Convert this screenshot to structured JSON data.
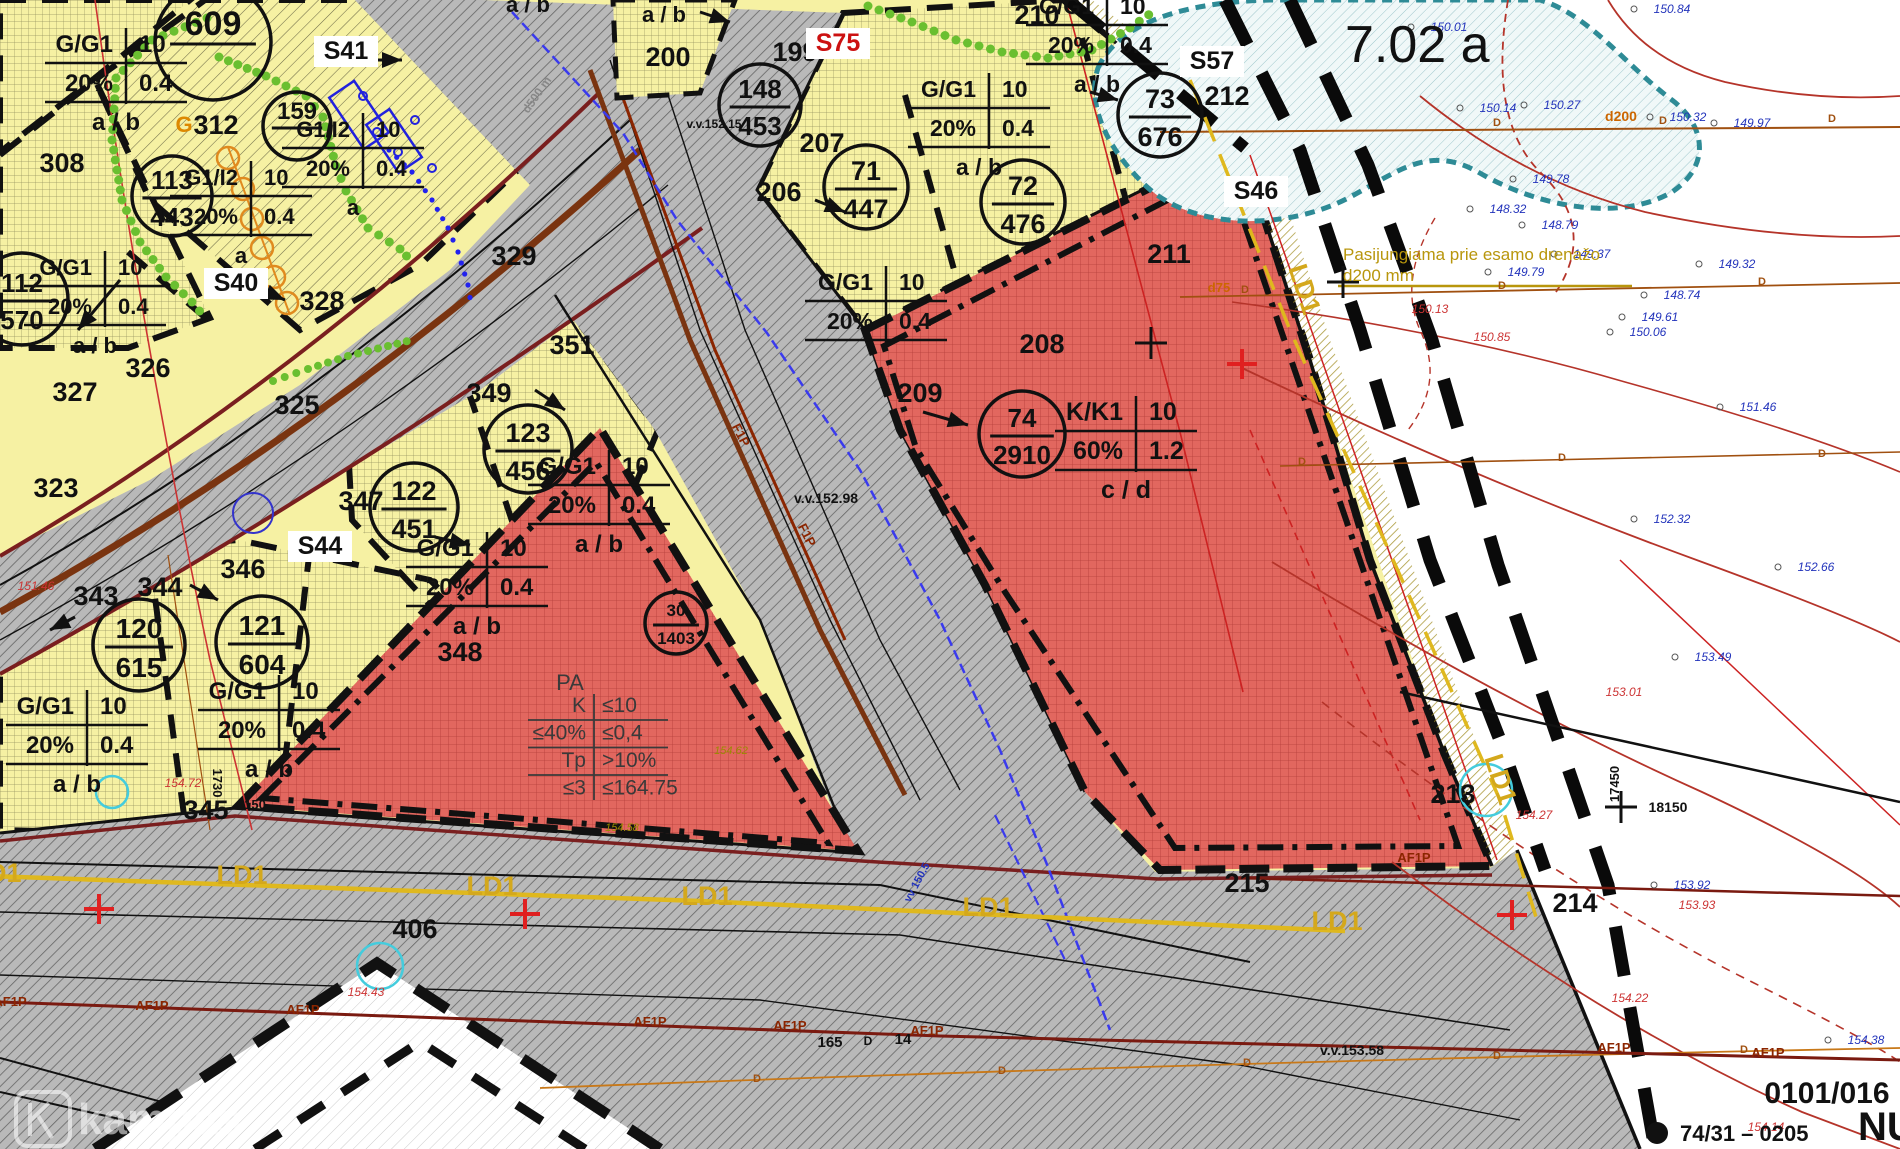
{
  "map": {
    "sheet_label": "7.02 a",
    "watermark": "kampas",
    "corner_code": "0101/016",
    "corner_line2": "74/31  –  0205",
    "corner_big": "NUOSAV",
    "note_line1": "Pasijungiama prie esamo drenažo",
    "note_line2": "d200 mm",
    "plot_markers": [
      {
        "top": "609",
        "bottom": "",
        "cx": 213,
        "cy": 42,
        "r": 58,
        "fs": 34
      },
      {
        "top": "113",
        "bottom": "443",
        "cx": 172,
        "cy": 196,
        "r": 40,
        "fs": 26
      },
      {
        "top": "159",
        "bottom": "",
        "cx": 297,
        "cy": 126,
        "r": 34,
        "fs": 24
      },
      {
        "top": "112",
        "bottom": "570",
        "cx": 22,
        "cy": 299,
        "r": 46,
        "fs": 26
      },
      {
        "top": "120",
        "bottom": "615",
        "cx": 139,
        "cy": 645,
        "r": 46,
        "fs": 28
      },
      {
        "top": "121",
        "bottom": "604",
        "cx": 262,
        "cy": 642,
        "r": 46,
        "fs": 28
      },
      {
        "top": "122",
        "bottom": "451",
        "cx": 414,
        "cy": 507,
        "r": 44,
        "fs": 27
      },
      {
        "top": "123",
        "bottom": "456",
        "cx": 528,
        "cy": 449,
        "r": 44,
        "fs": 27
      },
      {
        "top": "30",
        "bottom": "1403",
        "cx": 676,
        "cy": 623,
        "r": 31,
        "fs": 17
      },
      {
        "top": "148",
        "bottom": "453",
        "cx": 760,
        "cy": 105,
        "r": 41,
        "fs": 26
      },
      {
        "top": "71",
        "bottom": "447",
        "cx": 866,
        "cy": 187,
        "r": 42,
        "fs": 27
      },
      {
        "top": "72",
        "bottom": "476",
        "cx": 1023,
        "cy": 202,
        "r": 42,
        "fs": 27
      },
      {
        "top": "73",
        "bottom": "676",
        "cx": 1160,
        "cy": 115,
        "r": 42,
        "fs": 27
      },
      {
        "top": "74",
        "bottom": "2910",
        "cx": 1022,
        "cy": 434,
        "r": 43,
        "fs": 26
      }
    ],
    "zone_tables": [
      {
        "cx": 125,
        "y": 52,
        "rows": [
          [
            "G/G1",
            "10"
          ],
          [
            "20%",
            "0.4"
          ]
        ],
        "foot": "a / b",
        "fs": 24
      },
      {
        "cx": 250,
        "y": 185,
        "rows": [
          [
            "G1/I2",
            "10"
          ],
          [
            "20%",
            "0.4"
          ]
        ],
        "foot": "a",
        "fs": 22
      },
      {
        "cx": 362,
        "y": 137,
        "rows": [
          [
            "G1/I2",
            "10"
          ],
          [
            "20%",
            "0.4"
          ]
        ],
        "foot": "a",
        "fs": 22
      },
      {
        "cx": 104,
        "y": 275,
        "rows": [
          [
            "G/G1",
            "10"
          ],
          [
            "20%",
            "0.4"
          ]
        ],
        "foot": "a / b",
        "fs": 22
      },
      {
        "cx": 86,
        "y": 714,
        "rows": [
          [
            "G/G1",
            "10"
          ],
          [
            "20%",
            "0.4"
          ]
        ],
        "foot": "a / b",
        "fs": 24
      },
      {
        "cx": 278,
        "y": 699,
        "rows": [
          [
            "G/G1",
            "10"
          ],
          [
            "20%",
            "0.4"
          ]
        ],
        "foot": "a / b",
        "fs": 24
      },
      {
        "cx": 486,
        "y": 556,
        "rows": [
          [
            "G/G1",
            "10"
          ],
          [
            "20%",
            "0.4"
          ]
        ],
        "foot": "a / b",
        "fs": 24
      },
      {
        "cx": 608,
        "y": 474,
        "rows": [
          [
            "G/G1",
            "10"
          ],
          [
            "20%",
            "0.4"
          ]
        ],
        "foot": "a / b",
        "fs": 24
      },
      {
        "cx": 1106,
        "y": 14,
        "rows": [
          [
            "G/G1",
            "10"
          ],
          [
            "20%",
            "0.4"
          ]
        ],
        "foot": "a / b",
        "fs": 23
      },
      {
        "cx": 988,
        "y": 97,
        "rows": [
          [
            "G/G1",
            "10"
          ],
          [
            "20%",
            "0.4"
          ]
        ],
        "foot": "a / b",
        "fs": 23
      },
      {
        "cx": 885,
        "y": 290,
        "rows": [
          [
            "G/G1",
            "10"
          ],
          [
            "20%",
            "0.4"
          ]
        ],
        "foot": "",
        "fs": 23
      },
      {
        "cx": 1135,
        "y": 420,
        "rows": [
          [
            "K/K1",
            "10"
          ],
          [
            "60%",
            "1.2"
          ]
        ],
        "foot": "c / d",
        "fs": 25
      }
    ],
    "pa_table": {
      "cx": 596,
      "y": 712,
      "header": "PA",
      "rows": [
        [
          "K",
          "≤10"
        ],
        [
          "≤40%",
          "≤0,4"
        ],
        [
          "Tp",
          ">10%"
        ],
        [
          "≤3",
          "≤164.75"
        ]
      ]
    },
    "street_labels": [
      [
        62,
        172,
        "308"
      ],
      [
        216,
        134,
        "312"
      ],
      [
        148,
        377,
        "326"
      ],
      [
        75,
        401,
        "327"
      ],
      [
        297,
        414,
        "325"
      ],
      [
        56,
        497,
        "323"
      ],
      [
        514,
        265,
        "329"
      ],
      [
        322,
        310,
        "328"
      ],
      [
        96,
        605,
        "343"
      ],
      [
        160,
        596,
        "344"
      ],
      [
        206,
        819,
        "345"
      ],
      [
        243,
        578,
        "346"
      ],
      [
        361,
        510,
        "347"
      ],
      [
        460,
        661,
        "348"
      ],
      [
        489,
        402,
        "349"
      ],
      [
        572,
        354,
        "351"
      ],
      [
        795,
        61,
        "199"
      ],
      [
        668,
        66,
        "200"
      ],
      [
        779,
        201,
        "206"
      ],
      [
        822,
        152,
        "207"
      ],
      [
        1042,
        353,
        "208"
      ],
      [
        920,
        402,
        "209"
      ],
      [
        1037,
        24,
        "210"
      ],
      [
        1169,
        263,
        "211"
      ],
      [
        1227,
        105,
        "212"
      ],
      [
        1453,
        803,
        "213"
      ],
      [
        1575,
        912,
        "214"
      ],
      [
        1247,
        892,
        "215"
      ],
      [
        415,
        938,
        "406"
      ]
    ],
    "section_labels": [
      {
        "t": "S40",
        "x": 236,
        "y": 291,
        "col": "#111"
      },
      {
        "t": "S41",
        "x": 346,
        "y": 59,
        "col": "#111"
      },
      {
        "t": "S44",
        "x": 320,
        "y": 554,
        "col": "#111"
      },
      {
        "t": "S57",
        "x": 1212,
        "y": 69,
        "col": "#111"
      },
      {
        "t": "S46",
        "x": 1256,
        "y": 199,
        "col": "#111"
      },
      {
        "t": "S75",
        "x": 838,
        "y": 51,
        "col": "#cc1111"
      }
    ],
    "elev_blue": [
      [
        1672,
        13,
        "150.84"
      ],
      [
        1449,
        31,
        "150.01"
      ],
      [
        1498,
        112,
        "150.14"
      ],
      [
        1562,
        109,
        "150.27"
      ],
      [
        1688,
        121,
        "150.32"
      ],
      [
        1752,
        127,
        "149.97"
      ],
      [
        1551,
        183,
        "149.78"
      ],
      [
        1508,
        213,
        "148.32"
      ],
      [
        1560,
        229,
        "148.79"
      ],
      [
        1592,
        258,
        "149.37"
      ],
      [
        1526,
        276,
        "149.79"
      ],
      [
        1737,
        268,
        "149.32"
      ],
      [
        1660,
        321,
        "149.61"
      ],
      [
        1682,
        299,
        "148.74"
      ],
      [
        1648,
        336,
        "150.06"
      ],
      [
        1758,
        411,
        "151.46"
      ],
      [
        1672,
        523,
        "152.32"
      ],
      [
        1816,
        571,
        "152.66"
      ],
      [
        1713,
        661,
        "153.49"
      ],
      [
        1692,
        889,
        "153.92"
      ],
      [
        1866,
        1044,
        "154.38"
      ]
    ],
    "elev_red": [
      [
        1430,
        313,
        "150.13"
      ],
      [
        1492,
        341,
        "150.85"
      ],
      [
        1624,
        696,
        "153.01"
      ],
      [
        1534,
        819,
        "154.27"
      ],
      [
        1697,
        909,
        "153.93"
      ],
      [
        1630,
        1002,
        "154.22"
      ],
      [
        1766,
        1131,
        "154.14"
      ],
      [
        366,
        996,
        "154.43"
      ],
      [
        183,
        787,
        "154.72"
      ],
      [
        36,
        590,
        "151.46"
      ]
    ],
    "elev_olive": [
      [
        622,
        831,
        "154.58"
      ],
      [
        731,
        754,
        "154.62"
      ]
    ],
    "misc_labels": [
      {
        "t": "v.v.152.98",
        "x": 826,
        "y": 503,
        "fs": 14
      },
      {
        "t": "v.v.153.58",
        "x": 1352,
        "y": 1055,
        "fs": 14
      },
      {
        "t": "v.v.152.15",
        "x": 714,
        "y": 128,
        "fs": 12
      },
      {
        "t": "1730",
        "x": 213,
        "y": 783,
        "fs": 13,
        "rot": 90
      },
      {
        "t": "150",
        "x": 255,
        "y": 809,
        "fs": 13
      },
      {
        "t": "17450",
        "x": 1619,
        "y": 784,
        "fs": 13,
        "rot": -90
      },
      {
        "t": "18150",
        "x": 1668,
        "y": 812,
        "fs": 14
      },
      {
        "t": "d500 m",
        "x": 540,
        "y": 97,
        "fs": 12,
        "rot": -55,
        "col": "#888888"
      },
      {
        "t": "d200",
        "x": 1621,
        "y": 121,
        "fs": 14,
        "col": "#cc6600"
      },
      {
        "t": "d75",
        "x": 1219,
        "y": 292,
        "fs": 13,
        "col": "#cc6600"
      },
      {
        "t": "G",
        "x": 184,
        "y": 132,
        "fs": 22,
        "col": "#dd8800"
      },
      {
        "t": "a / b",
        "x": 528,
        "y": 12,
        "fs": 22
      },
      {
        "t": "a / b",
        "x": 664,
        "y": 22,
        "fs": 22
      },
      {
        "t": "165",
        "x": 830,
        "y": 1047,
        "fs": 15
      },
      {
        "t": "D",
        "x": 868,
        "y": 1045,
        "fs": 12
      },
      {
        "t": "14",
        "x": 903,
        "y": 1044,
        "fs": 15
      },
      {
        "t": "vv 150.5",
        "x": 920,
        "y": 884,
        "fs": 11,
        "col": "#2233bb",
        "rot": -62
      }
    ],
    "ld1_labels": [
      [
        -4,
        882,
        0
      ],
      [
        242,
        884,
        0
      ],
      [
        492,
        895,
        0
      ],
      [
        707,
        905,
        0
      ],
      [
        988,
        916,
        0
      ],
      [
        1337,
        930,
        0
      ],
      [
        1296,
        292,
        72
      ],
      [
        1492,
        782,
        72
      ]
    ],
    "ld1_text": "LD1",
    "af1p_labels": [
      [
        10,
        1006
      ],
      [
        152,
        1010
      ],
      [
        303,
        1014
      ],
      [
        650,
        1026
      ],
      [
        790,
        1030
      ],
      [
        927,
        1035
      ],
      [
        1614,
        1052
      ],
      [
        1768,
        1057
      ],
      [
        1414,
        862
      ]
    ],
    "af1p_text": "AF1P",
    "f1p_labels": [
      [
        737,
        437,
        63
      ],
      [
        803,
        537,
        63
      ]
    ],
    "f1p_text": "F1P",
    "d_marks": [
      [
        1497,
        126
      ],
      [
        1663,
        124
      ],
      [
        1832,
        122
      ],
      [
        1245,
        293
      ],
      [
        1502,
        289
      ],
      [
        1762,
        285
      ],
      [
        1302,
        465
      ],
      [
        1562,
        461
      ],
      [
        1822,
        457
      ],
      [
        757,
        1082
      ],
      [
        1002,
        1074
      ],
      [
        1247,
        1066
      ],
      [
        1497,
        1059
      ],
      [
        1744,
        1053
      ]
    ],
    "crosses_red": [
      [
        99,
        909
      ],
      [
        525,
        914
      ],
      [
        1242,
        364
      ],
      [
        1512,
        915
      ]
    ],
    "crosses_black": [
      [
        1151,
        343
      ],
      [
        1621,
        807
      ],
      [
        1343,
        282
      ]
    ]
  }
}
